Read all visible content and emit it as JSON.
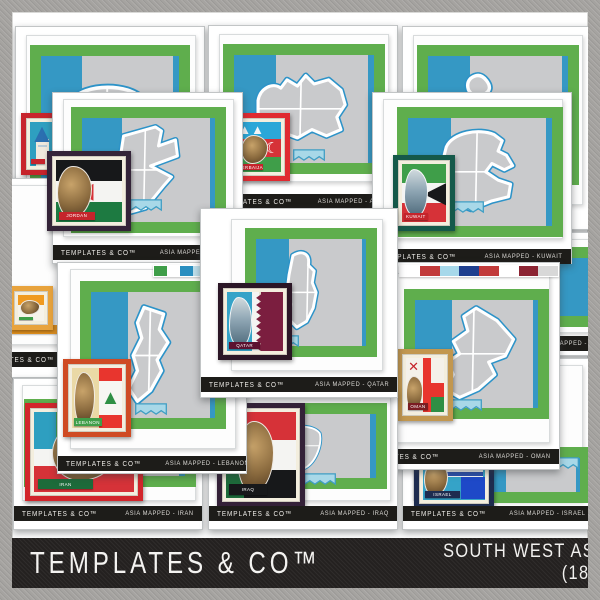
{
  "product": {
    "brand": "TEMPLATES & CO™",
    "title_line1": "SOUTH WEST ASIA MAPPED",
    "title_line2": "(18 MAP SETS}"
  },
  "palette": {
    "frame_green": "#5fae4d",
    "sky_blue": "#3598c4",
    "map_gray": "#c9cacc",
    "map_outline_blue": "#2d93c8",
    "strip_black": "#1d1c19",
    "banner_black": "#242120",
    "border_gray": "#a5a3a0",
    "badge_mat_cream": "#f3eede"
  },
  "cards": [
    {
      "id": "back-left",
      "map": "generic",
      "badge": {
        "frame": "#c7242c",
        "banner": {
          "text": "",
          "color": "#c7242c"
        },
        "parts": [
          {
            "k": "block",
            "x": 0,
            "y": 0,
            "w": 100,
            "h": 100,
            "c": "#2e9fc0"
          },
          {
            "k": "block",
            "x": 22,
            "y": 38,
            "w": 50,
            "h": 62,
            "c": "#efe9dd"
          },
          {
            "k": "glyph",
            "x": 14,
            "y": 2,
            "w": 64,
            "h": 44,
            "c": "#2b6fb0",
            "t": "▲",
            "fs": 26
          },
          {
            "k": "block",
            "x": 30,
            "y": 52,
            "w": 34,
            "h": 5,
            "c": "#b9ccd8"
          }
        ]
      }
    },
    {
      "id": "azerbaijan",
      "brand": "TEMPLATES & CO™",
      "label": "ASIA MAPPED - AZERBAIJAN",
      "map": "azerbaijan",
      "badge": {
        "frame": "#e02a30",
        "banner": {
          "text": "AZERBAIJAN",
          "color": "#c5242b"
        },
        "parts": [
          {
            "k": "block",
            "x": 0,
            "y": 0,
            "w": 100,
            "h": 34,
            "c": "#2aa7d8"
          },
          {
            "k": "block",
            "x": 0,
            "y": 34,
            "w": 100,
            "h": 36,
            "c": "#d63238"
          },
          {
            "k": "block",
            "x": 0,
            "y": 70,
            "w": 100,
            "h": 30,
            "c": "#3f9e49"
          },
          {
            "k": "glyph",
            "x": 60,
            "y": 30,
            "w": 40,
            "h": 44,
            "c": "#ffffff",
            "t": "☾",
            "fs": 15
          },
          {
            "k": "glyph",
            "x": 2,
            "y": 0,
            "w": 60,
            "h": 30,
            "c": "#f4f6f7",
            "t": "▲▲",
            "fs": 13
          },
          {
            "k": "photo",
            "x": 8,
            "y": 26,
            "w": 62,
            "h": 58
          }
        ]
      }
    },
    {
      "id": "back-right",
      "map": "bahrain"
    },
    {
      "id": "georgia",
      "label": "ASIA MAPPED - GEORGIA",
      "map": "georgia",
      "stripMode": "country-left"
    },
    {
      "id": "kuwait",
      "brand": "TEMPLATES & CO™",
      "label": "ASIA MAPPED - KUWAIT",
      "map": "kuwait",
      "badge": {
        "frame": "#15594a",
        "banner": {
          "text": "KUWAIT",
          "color": "#c5242b"
        },
        "parts": [
          {
            "k": "block",
            "x": 0,
            "y": 0,
            "w": 100,
            "h": 33,
            "c": "#3f9e49"
          },
          {
            "k": "block",
            "x": 0,
            "y": 33,
            "w": 100,
            "h": 34,
            "c": "#f4f4f2"
          },
          {
            "k": "block",
            "x": 0,
            "y": 67,
            "w": 100,
            "h": 33,
            "c": "#d63238"
          },
          {
            "k": "glyph",
            "x": 52,
            "y": 0,
            "w": 48,
            "h": 100,
            "c": "#17181a",
            "t": "◀",
            "fs": 30
          },
          {
            "k": "photo-city",
            "x": 4,
            "y": 8,
            "w": 56,
            "h": 84
          }
        ]
      }
    },
    {
      "id": "israel",
      "brand": "TEMPLATES & CO™",
      "label": "ASIA MAPPED - ISRAEL",
      "map": "none",
      "badge": {
        "frame": "#1e2c4f",
        "banner": {
          "text": "ISRAEL",
          "color": "#1e2c4f"
        },
        "parts": [
          {
            "k": "block",
            "x": 0,
            "y": 0,
            "w": 100,
            "h": 100,
            "c": "#35a3c8"
          },
          {
            "k": "block",
            "x": 34,
            "y": 8,
            "w": 62,
            "h": 50,
            "c": "#f4f6f8"
          },
          {
            "k": "block",
            "x": 34,
            "y": 14,
            "w": 62,
            "h": 7,
            "c": "#2a4fae"
          },
          {
            "k": "block",
            "x": 34,
            "y": 48,
            "w": 62,
            "h": 7,
            "c": "#2a4fae"
          },
          {
            "k": "glyph",
            "x": 46,
            "y": 20,
            "w": 38,
            "h": 28,
            "c": "#2a4fae",
            "t": "✶",
            "fs": 12
          },
          {
            "k": "block",
            "x": 62,
            "y": 58,
            "w": 38,
            "h": 40,
            "c": "#1e49c8"
          },
          {
            "k": "photo",
            "x": 2,
            "y": 30,
            "w": 38,
            "h": 62
          }
        ]
      }
    },
    {
      "id": "oman",
      "brand": "TEMPLATES & CO™",
      "label": "ASIA MAPPED - OMAN",
      "map": "oman",
      "badge": {
        "frame": "#c2974f",
        "banner": {
          "text": "OMAN",
          "color": "#7a1d22"
        },
        "parts": [
          {
            "k": "block",
            "x": 0,
            "y": 0,
            "w": 100,
            "h": 100,
            "c": "#f4f1ea"
          },
          {
            "k": "block",
            "x": 44,
            "y": 0,
            "w": 22,
            "h": 100,
            "c": "#e8352e"
          },
          {
            "k": "block",
            "x": 44,
            "y": 46,
            "w": 56,
            "h": 26,
            "c": "#e8352e"
          },
          {
            "k": "block",
            "x": 66,
            "y": 72,
            "w": 34,
            "h": 28,
            "c": "#2f8f44"
          },
          {
            "k": "glyph",
            "x": 2,
            "y": 0,
            "w": 36,
            "h": 30,
            "c": "#c5242b",
            "t": "✕",
            "fs": 13
          },
          {
            "k": "photo",
            "x": 0,
            "y": 34,
            "w": 46,
            "h": 62
          }
        ]
      }
    },
    {
      "id": "cyprus",
      "brand": "TEMPLATES & CO™",
      "stripMode": "brand-only",
      "map": "generic",
      "badge": {
        "frame": "#e8a33d",
        "banner": {
          "text": "",
          "color": "#3f9e49"
        },
        "parts": [
          {
            "k": "block",
            "x": 0,
            "y": 0,
            "w": 100,
            "h": 38,
            "c": "#f09a20"
          },
          {
            "k": "block",
            "x": 0,
            "y": 38,
            "w": 100,
            "h": 62,
            "c": "#f6f3ea"
          },
          {
            "k": "photo",
            "x": 8,
            "y": 18,
            "w": 78,
            "h": 58
          }
        ]
      }
    },
    {
      "id": "jordan",
      "brand": "TEMPLATES & CO™",
      "label": "ASIA MAPPED - JORDAN",
      "map": "jordan",
      "badge": {
        "frame": "#342438",
        "banner": {
          "text": "JORDAN",
          "color": "#c5242b"
        },
        "parts": [
          {
            "k": "block",
            "x": 0,
            "y": 0,
            "w": 100,
            "h": 34,
            "c": "#17181a"
          },
          {
            "k": "block",
            "x": 0,
            "y": 34,
            "w": 100,
            "h": 33,
            "c": "#f4f4f2"
          },
          {
            "k": "block",
            "x": 0,
            "y": 67,
            "w": 100,
            "h": 33,
            "c": "#1d7a41"
          },
          {
            "k": "glyph",
            "x": 26,
            "y": 26,
            "w": 36,
            "h": 48,
            "c": "#d63238",
            "t": "◀",
            "fs": 22
          },
          {
            "k": "photo",
            "x": 2,
            "y": 10,
            "w": 52,
            "h": 84
          }
        ]
      }
    },
    {
      "id": "iran",
      "brand": "TEMPLATES & CO™",
      "label": "ASIA MAPPED - IRAN",
      "map": "generic",
      "badge": {
        "frame": "#d2252b",
        "banner": {
          "text": "IRAN",
          "color": "#1d6b3a"
        },
        "parts": [
          {
            "k": "block",
            "x": 0,
            "y": 0,
            "w": 100,
            "h": 34,
            "c": "#3f9e49"
          },
          {
            "k": "block",
            "x": 0,
            "y": 34,
            "w": 100,
            "h": 33,
            "c": "#f4f4f2"
          },
          {
            "k": "block",
            "x": 0,
            "y": 67,
            "w": 100,
            "h": 33,
            "c": "#d63238"
          },
          {
            "k": "block",
            "x": 0,
            "y": 0,
            "w": 22,
            "h": 46,
            "c": "#2e9fc0"
          },
          {
            "k": "photo",
            "x": 18,
            "y": 14,
            "w": 66,
            "h": 72
          }
        ]
      }
    },
    {
      "id": "iraq",
      "brand": "TEMPLATES & CO™",
      "label": "ASIA MAPPED - IRAQ",
      "map": "generic",
      "badge": {
        "frame": "#342138",
        "banner": {
          "text": "IRAQ",
          "color": "#17181a"
        },
        "parts": [
          {
            "k": "block",
            "x": 0,
            "y": 0,
            "w": 100,
            "h": 33,
            "c": "#d63238"
          },
          {
            "k": "block",
            "x": 0,
            "y": 33,
            "w": 100,
            "h": 34,
            "c": "#f4f4f2"
          },
          {
            "k": "block",
            "x": 0,
            "y": 67,
            "w": 100,
            "h": 33,
            "c": "#17181a"
          },
          {
            "k": "block",
            "x": 0,
            "y": 0,
            "w": 26,
            "h": 100,
            "c": "#1d6b3a"
          },
          {
            "k": "glyph",
            "x": 34,
            "y": 38,
            "w": 32,
            "h": 24,
            "c": "#1d7a41",
            "t": "ٱ",
            "fs": 9
          },
          {
            "k": "photo",
            "x": 16,
            "y": 10,
            "w": 52,
            "h": 84
          }
        ]
      }
    },
    {
      "id": "lebanon",
      "brand": "TEMPLATES & CO™",
      "label": "ASIA MAPPED - LEBANON",
      "map": "lebanon",
      "badge": {
        "frame": "#cf4b24",
        "banner": {
          "text": "LEBANON",
          "color": "#3f9e49"
        },
        "parts": [
          {
            "k": "block",
            "x": 0,
            "y": 0,
            "w": 54,
            "h": 100,
            "c": "#ead9a6"
          },
          {
            "k": "block",
            "x": 54,
            "y": 0,
            "w": 46,
            "h": 22,
            "c": "#e8352e"
          },
          {
            "k": "block",
            "x": 54,
            "y": 22,
            "w": 46,
            "h": 56,
            "c": "#f7f6f2"
          },
          {
            "k": "block",
            "x": 54,
            "y": 78,
            "w": 46,
            "h": 22,
            "c": "#e8352e"
          },
          {
            "k": "glyph",
            "x": 56,
            "y": 22,
            "w": 42,
            "h": 56,
            "c": "#2f8f44",
            "t": "▲",
            "fs": 20
          },
          {
            "k": "photo",
            "x": 4,
            "y": 6,
            "w": 42,
            "h": 90
          }
        ]
      }
    },
    {
      "id": "qatar",
      "brand": "TEMPLATES & CO™",
      "label": "ASIA MAPPED - QATAR",
      "map": "qatar",
      "badge": {
        "frame": "#2b1626",
        "banner": {
          "text": "QATAR",
          "color": "#5c1230"
        },
        "parts": [
          {
            "k": "block",
            "x": 0,
            "y": 0,
            "w": 56,
            "h": 100,
            "c": "#35a3c8"
          },
          {
            "k": "block",
            "x": 44,
            "y": 0,
            "w": 14,
            "h": 100,
            "c": "#f4f4f2"
          },
          {
            "k": "zigzag",
            "x": 52,
            "y": 0,
            "w": 48,
            "h": 100,
            "c": "#7b1e3f"
          },
          {
            "k": "photo-city",
            "x": 4,
            "y": 8,
            "w": 40,
            "h": 86
          }
        ]
      }
    }
  ],
  "chips": {
    "oman_top": [
      "#ffffff",
      "#c23b3b",
      "#a6d8ea",
      "#1f3f8f",
      "#c23b3b",
      "#ffffff",
      "#8c2433",
      "#d8d8d8"
    ],
    "lebanon_top": [
      "#3f9e49",
      "#ffffff",
      "#2a8fc0",
      "#bfe0ec"
    ]
  }
}
